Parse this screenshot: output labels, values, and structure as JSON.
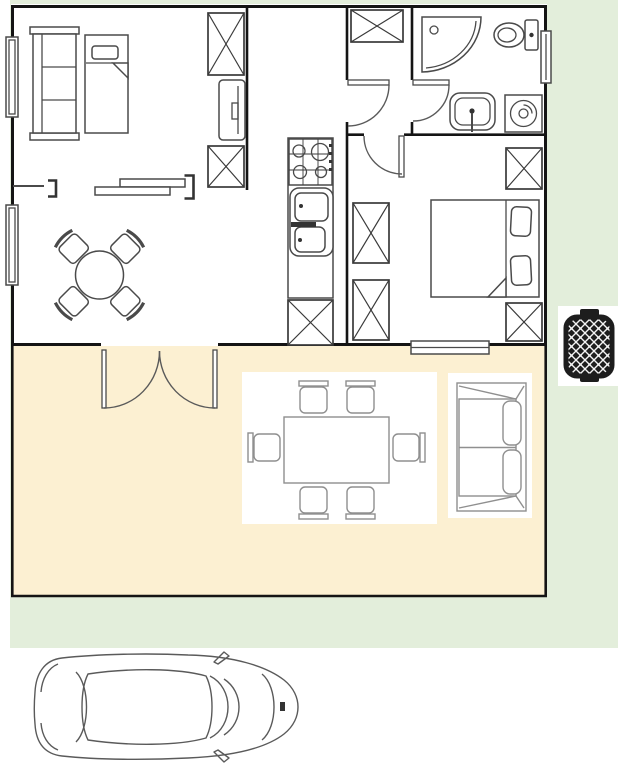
{
  "canvas": {
    "width": 625,
    "height": 768,
    "background": "#ffffff"
  },
  "colors": {
    "lawn_green": "#E3EEDB",
    "terrace_cream": "#FCF0D2",
    "wall_black": "#141414",
    "furniture_line": "#4a4a4a",
    "outdoor_line": "#8f8f8f",
    "mat_white": "#ffffff",
    "grill_black": "#1D1D1D",
    "car_line": "#5a5a5a"
  },
  "floor_plan": {
    "type": "apartment-floor-plan-with-terrace-garden-and-car",
    "rooms": [
      {
        "name": "living-room",
        "items": [
          "wardrobe-shelf",
          "single-bed",
          "window",
          "window",
          "radiator-bracket",
          "sideboard",
          "storage-box",
          "tv-panel",
          "storage-box",
          "round-dining-table",
          "dining-chair-x4",
          "french-doors-to-terrace"
        ]
      },
      {
        "name": "kitchen",
        "items": [
          "counter",
          "stove-4-burners",
          "double-sink",
          "storage-box"
        ]
      },
      {
        "name": "entry-hall",
        "items": [
          "closet-box",
          "door-to-living",
          "door-to-bathroom",
          "door-to-bedroom"
        ]
      },
      {
        "name": "bathroom",
        "items": [
          "corner-shower",
          "toilet",
          "wash-basin",
          "washing-machine",
          "window"
        ]
      },
      {
        "name": "bedroom",
        "items": [
          "double-bed-with-2-pillows",
          "wardrobe-box-x2",
          "storage-box-x2",
          "window"
        ]
      },
      {
        "name": "terrace",
        "items": [
          "outdoor-rug",
          "outdoor-dining-table",
          "outdoor-chair-x6",
          "outdoor-sofa"
        ]
      },
      {
        "name": "garden",
        "items": [
          "bbq-grill"
        ]
      },
      {
        "name": "driveway",
        "items": [
          "car-top-view"
        ]
      }
    ]
  }
}
